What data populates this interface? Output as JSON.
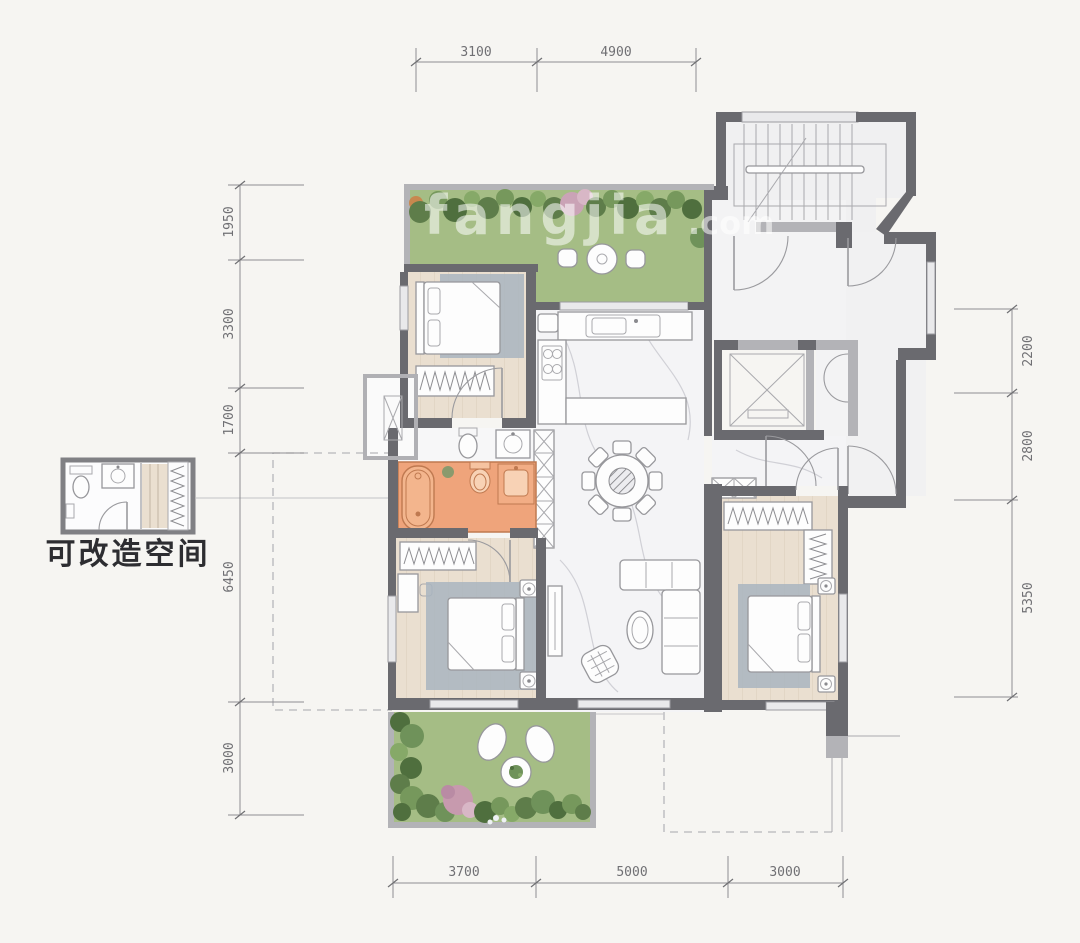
{
  "dimensions": {
    "top": [
      "3100",
      "4900"
    ],
    "left": [
      "1950",
      "3300",
      "1700",
      "6450",
      "3000"
    ],
    "right": [
      "2200",
      "2800",
      "5350"
    ],
    "bottom": [
      "3700",
      "5000",
      "3000"
    ]
  },
  "inset": {
    "label": "可改造空间"
  },
  "watermark": {
    "name": "fangjia",
    "tld": ".com"
  },
  "palette": {
    "background": "#f6f5f2",
    "wall_dark": "#6a6a6f",
    "wall_light": "#b3b3b7",
    "wood_floor": "#eadfd0",
    "marble_floor": "#f4f4f6",
    "garden_green": "#a5bd85",
    "shrub_green": "#5e7d4a",
    "rug_blue": "#a9b5c0",
    "highlight_orange": "#efa47b",
    "highlight_orange_stroke": "#bf7950",
    "dimension_text": "#707074"
  }
}
